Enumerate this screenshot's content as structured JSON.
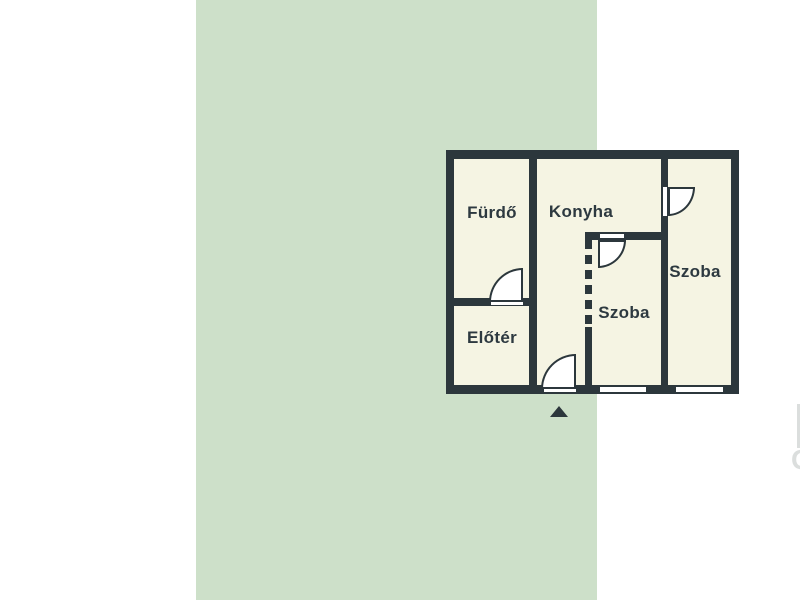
{
  "colors": {
    "page_background": "#ffffff",
    "panel_background": "#cde0c9",
    "wall": "#2c373c",
    "floor": "#f5f4e3",
    "fittings": "#ffffff",
    "label_text": "#2d3940"
  },
  "floorplan": {
    "rooms": [
      {
        "name": "bathroom",
        "label": "Fürdő"
      },
      {
        "name": "kitchen",
        "label": "Konyha"
      },
      {
        "name": "hallway",
        "label": "Előtér"
      },
      {
        "name": "room-middle",
        "label": "Szoba"
      },
      {
        "name": "room-right",
        "label": "Szoba"
      }
    ],
    "watermark_letter": "G"
  }
}
